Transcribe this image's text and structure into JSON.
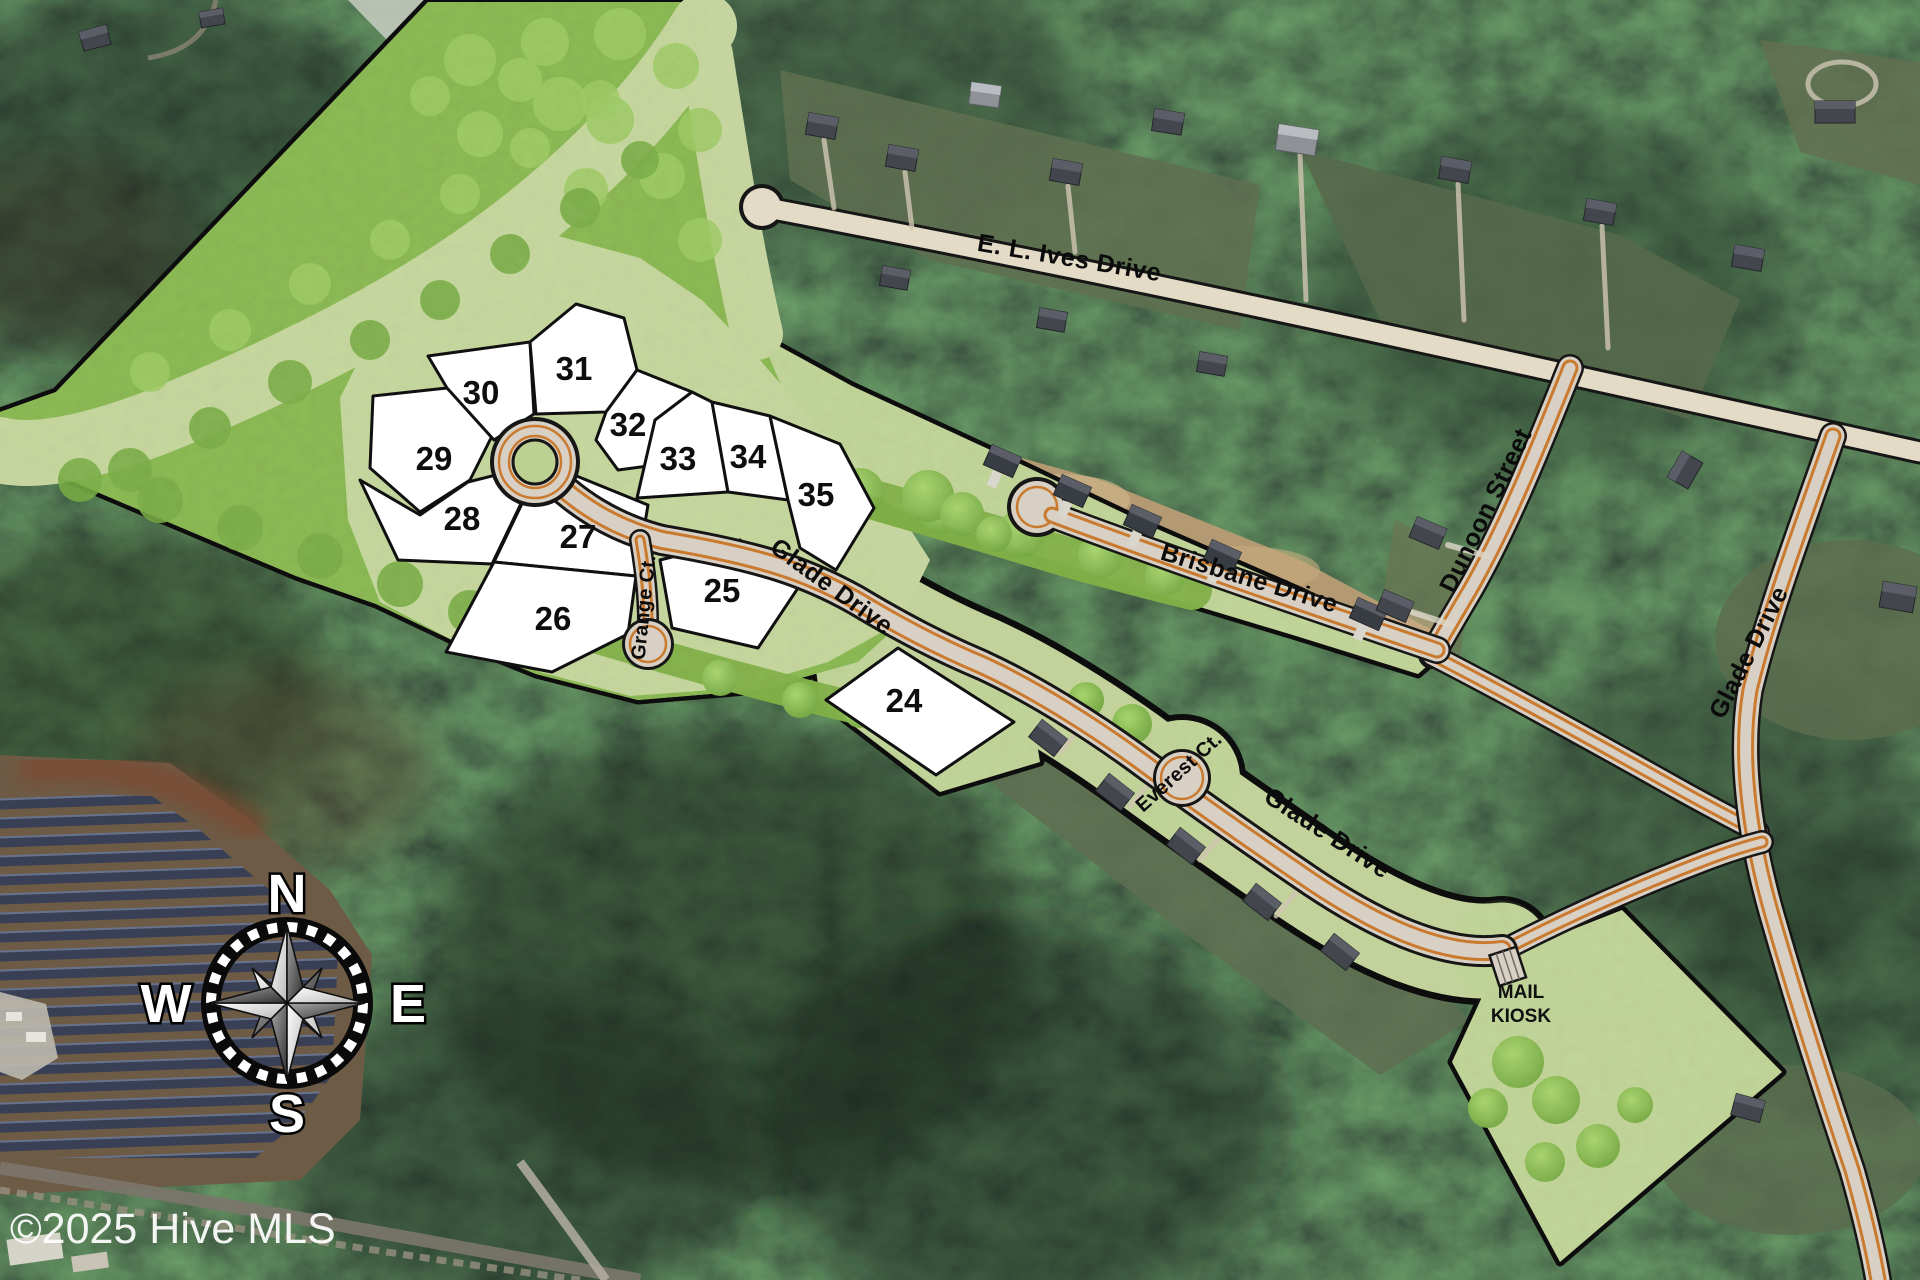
{
  "map_title": "Subdivision site plan over aerial photo",
  "watermark": "©2025 Hive MLS",
  "mail_kiosk": {
    "line1": "MAIL",
    "line2": "KIOSK"
  },
  "compass": {
    "n": "N",
    "e": "E",
    "s": "S",
    "w": "W"
  },
  "lots": [
    {
      "number": "24"
    },
    {
      "number": "25"
    },
    {
      "number": "26"
    },
    {
      "number": "27"
    },
    {
      "number": "28"
    },
    {
      "number": "29"
    },
    {
      "number": "30"
    },
    {
      "number": "31"
    },
    {
      "number": "32"
    },
    {
      "number": "33"
    },
    {
      "number": "34"
    },
    {
      "number": "35"
    }
  ],
  "streets": {
    "ives": "E. L. Ives Drive",
    "brisbane": "Brisbane Drive",
    "dunoon": "Dunoon Street",
    "glade_main": "Glade Drive",
    "glade_mid": "Glade Drive",
    "glade_east": "Glade Drive",
    "grange": "Grange Ct.",
    "everest": "Everest Ct."
  },
  "colors": {
    "parcel_green": "#c2d29a",
    "canopy_green": "#85b44e",
    "road_tan": "#d8d0c4",
    "road_orange": "#c97a2e",
    "lot_white": "#ffffff",
    "boundary_black": "#0d0d0d",
    "forest_dark": "#243225",
    "solar_panel": "#394055"
  }
}
